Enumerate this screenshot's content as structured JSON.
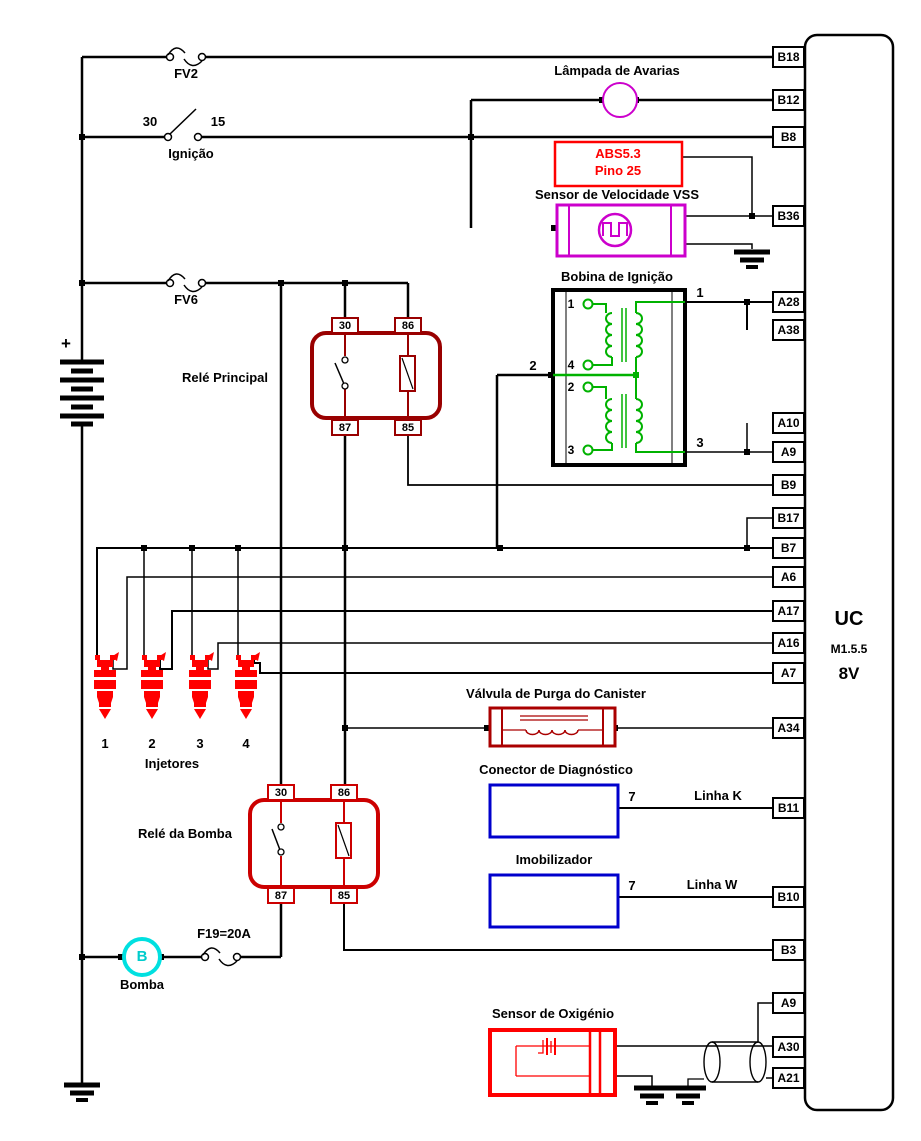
{
  "ecu": {
    "name": "UC",
    "model": "M1.5.5",
    "version": "8V",
    "pins": [
      "B18",
      "B12",
      "B8",
      "B36",
      "A28",
      "A38",
      "A10",
      "A9",
      "B9",
      "B17",
      "B7",
      "A6",
      "A17",
      "A16",
      "A7",
      "A34",
      "B11",
      "B10",
      "B3",
      "A9",
      "A30",
      "A21"
    ]
  },
  "power": {
    "battery_polarity": "+",
    "fuse_fv2": "FV2",
    "fuse_fv6": "FV6",
    "fuse_f19": "F19=20A",
    "ignition": {
      "label": "Ignição",
      "left": "30",
      "right": "15"
    }
  },
  "lamp": {
    "label": "Lâmpada de Avarias"
  },
  "abs": {
    "line1": "ABS5.3",
    "line2": "Pino 25"
  },
  "vss": {
    "label": "Sensor de Velocidade VSS"
  },
  "coil": {
    "label": "Bobina de Ignição",
    "terminals": [
      "1",
      "4",
      "2",
      "3"
    ],
    "wires": [
      "1",
      "2",
      "3"
    ]
  },
  "main_relay": {
    "label": "Relé Principal",
    "t30": "30",
    "t86": "86",
    "t87": "87",
    "t85": "85"
  },
  "pump_relay": {
    "label": "Relé da Bomba",
    "t30": "30",
    "t86": "86",
    "t87": "87",
    "t85": "85"
  },
  "injectors": {
    "label": "Injetores",
    "numbers": [
      "1",
      "2",
      "3",
      "4"
    ]
  },
  "canister": {
    "label": "Válvula de Purga do Canister"
  },
  "diagnostic": {
    "label": "Conector de Diagnóstico",
    "pin": "7",
    "line": "Linha K"
  },
  "immobilizer": {
    "label": "Imobilizador",
    "pin": "7",
    "line": "Linha W"
  },
  "pump": {
    "label": "Bomba",
    "letter": "B"
  },
  "oxygen": {
    "label": "Sensor de Oxigénio"
  },
  "colors": {
    "wire": "#000000",
    "main_relay_red": "#990000",
    "pump_relay_red": "#cc0000",
    "component_red": "#ff0000",
    "magenta": "#cc00cc",
    "green": "#00b200",
    "blue": "#0000cc",
    "cyan": "#00e0e0"
  }
}
